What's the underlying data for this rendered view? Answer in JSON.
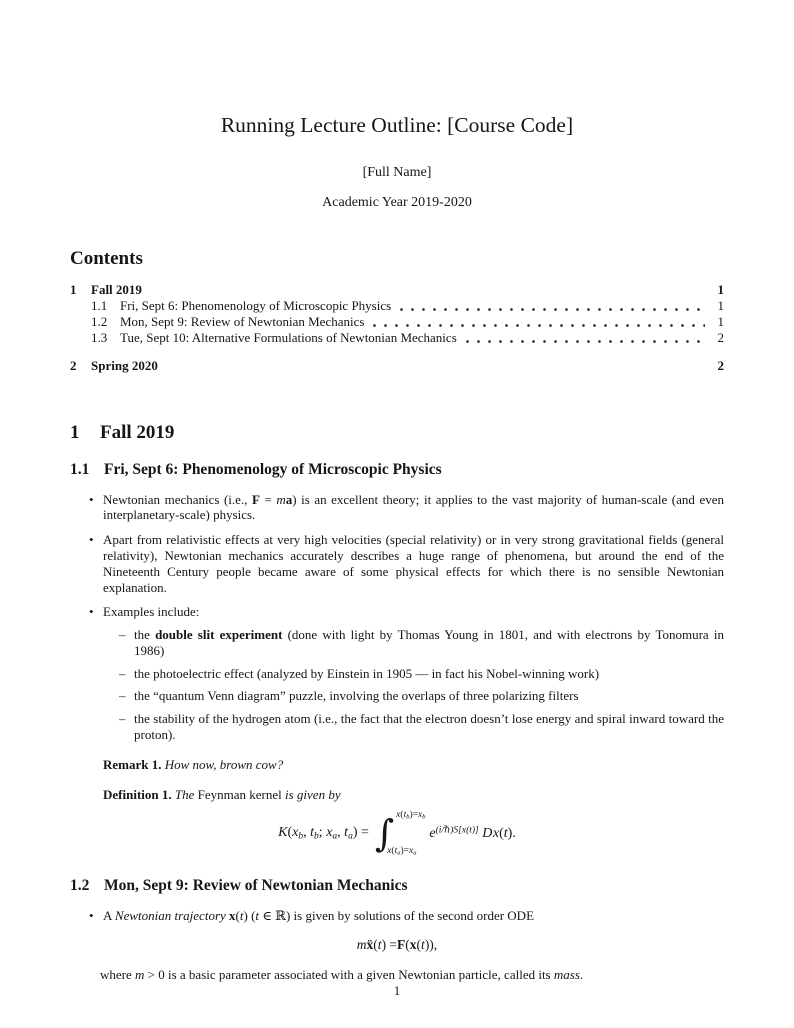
{
  "header": {
    "title": "Running Lecture Outline: [Course Code]",
    "author": "[Full Name]",
    "date": "Academic Year 2019-2020"
  },
  "toc": {
    "heading": "Contents",
    "entries": [
      {
        "num": "1",
        "label": "Fall 2019",
        "page": "1"
      },
      {
        "num": "1.1",
        "label": "Fri, Sept 6: Phenomenology of Microscopic Physics",
        "page": "1"
      },
      {
        "num": "1.2",
        "label": "Mon, Sept 9: Review of Newtonian Mechanics",
        "page": "1"
      },
      {
        "num": "1.3",
        "label": "Tue, Sept 10: Alternative Formulations of Newtonian Mechanics",
        "page": "2"
      },
      {
        "num": "2",
        "label": "Spring 2020",
        "page": "2"
      }
    ]
  },
  "sections": {
    "s1": {
      "num": "1",
      "title": "Fall 2019"
    },
    "s1_1": {
      "num": "1.1",
      "title": "Fri, Sept 6: Phenomenology of Microscopic Physics"
    },
    "s1_2": {
      "num": "1.2",
      "title": "Mon, Sept 9: Review of Newtonian Mechanics"
    }
  },
  "content": {
    "bullet1": [
      {
        "t": "Newtonian mechanics (i.e., "
      },
      {
        "t": "F",
        "s": "b"
      },
      {
        "t": " = "
      },
      {
        "t": "m",
        "s": "i"
      },
      {
        "t": "a",
        "s": "b"
      },
      {
        "t": ") is an excellent theory; it applies to the vast majority of human-scale (and even interplanetary-scale) physics."
      }
    ],
    "bullet2": [
      {
        "t": "Apart from relativistic effects at very high velocities (special relativity) or in very strong gravitational fields (general relativity), Newtonian mechanics accurately describes a huge range of phenomena, but around the end of the Nineteenth Century people became aware of some physical effects for which there is no sensible Newtonian explanation."
      }
    ],
    "bullet3": [
      {
        "t": "Examples include:"
      }
    ],
    "sub1": [
      {
        "t": "the "
      },
      {
        "t": "double slit experiment",
        "s": "b"
      },
      {
        "t": " (done with light by Thomas Young in 1801, and with electrons by Tonomura in 1986)"
      }
    ],
    "sub2": [
      {
        "t": "the photoelectric effect (analyzed by Einstein in 1905 — in fact his Nobel-winning work)"
      }
    ],
    "sub3": [
      {
        "t": "the “quantum Venn diagram” puzzle, involving the overlaps of three polarizing filters"
      }
    ],
    "sub4": [
      {
        "t": "the stability of the hydrogen atom (i.e., the fact that the electron doesn’t lose energy and spiral inward toward the proton)."
      }
    ],
    "remark": [
      {
        "t": "Remark 1.",
        "s": "b"
      },
      {
        "t": " "
      },
      {
        "t": "How now, brown cow?",
        "s": "i"
      }
    ],
    "definition": [
      {
        "t": "Definition 1.",
        "s": "b"
      },
      {
        "t": " "
      },
      {
        "t": "The ",
        "s": "i"
      },
      {
        "t": "Feynman kernel"
      },
      {
        "t": " is given by",
        "s": "i"
      }
    ],
    "formula1_lhs": [
      {
        "t": "K",
        "s": "i"
      },
      {
        "t": "("
      },
      {
        "t": "x",
        "s": "i"
      },
      {
        "t": "b",
        "s": "sub"
      },
      {
        "t": ", "
      },
      {
        "t": "t",
        "s": "i"
      },
      {
        "t": "b",
        "s": "sub"
      },
      {
        "t": "; "
      },
      {
        "t": "x",
        "s": "i"
      },
      {
        "t": "a",
        "s": "sub"
      },
      {
        "t": ", "
      },
      {
        "t": "t",
        "s": "i"
      },
      {
        "t": "a",
        "s": "sub"
      },
      {
        "t": ") = "
      }
    ],
    "formula1_int": "∫",
    "formula1_upper": [
      {
        "t": "x",
        "s": "i"
      },
      {
        "t": "("
      },
      {
        "t": "t",
        "s": "i"
      },
      {
        "t": "b",
        "s": "sub"
      },
      {
        "t": ")="
      },
      {
        "t": "x",
        "s": "i"
      },
      {
        "t": "b",
        "s": "sub"
      }
    ],
    "formula1_lower": [
      {
        "t": "x",
        "s": "i"
      },
      {
        "t": "("
      },
      {
        "t": "t",
        "s": "i"
      },
      {
        "t": "a",
        "s": "sub"
      },
      {
        "t": ")="
      },
      {
        "t": "x",
        "s": "i"
      },
      {
        "t": "a",
        "s": "sub"
      }
    ],
    "formula1_integrand": [
      {
        "t": "e",
        "s": "i"
      },
      {
        "t": "(i/ℏ)S[x(t)]",
        "s": "sup"
      },
      {
        "t": " "
      },
      {
        "t": "D",
        "s": "scr"
      },
      {
        "t": "x",
        "s": "i"
      },
      {
        "t": "("
      },
      {
        "t": "t",
        "s": "i"
      },
      {
        "t": ")."
      }
    ],
    "bullet4": [
      {
        "t": "A "
      },
      {
        "t": "Newtonian trajectory ",
        "s": "i"
      },
      {
        "t": "x",
        "s": "b"
      },
      {
        "t": "("
      },
      {
        "t": "t",
        "s": "i"
      },
      {
        "t": ") ("
      },
      {
        "t": "t",
        "s": "i"
      },
      {
        "t": " ∈ ℝ) is given by solutions of the second order ODE"
      }
    ],
    "formula2": [
      {
        "t": "m",
        "s": "i"
      },
      {
        "t": " "
      },
      {
        "t": "ẍ",
        "s": "b"
      },
      {
        "t": "("
      },
      {
        "t": "t",
        "s": "i"
      },
      {
        "t": ") = "
      },
      {
        "t": "F",
        "s": "b"
      },
      {
        "t": "("
      },
      {
        "t": "x",
        "s": "b"
      },
      {
        "t": "("
      },
      {
        "t": "t",
        "s": "i"
      },
      {
        "t": ")),"
      }
    ],
    "after2": [
      {
        "t": "where "
      },
      {
        "t": "m",
        "s": "i"
      },
      {
        "t": " > 0 is a basic parameter associated with a given Newtonian particle, called its "
      },
      {
        "t": "mass",
        "s": "i"
      },
      {
        "t": "."
      }
    ]
  },
  "page": {
    "footer_page_number": "1"
  }
}
